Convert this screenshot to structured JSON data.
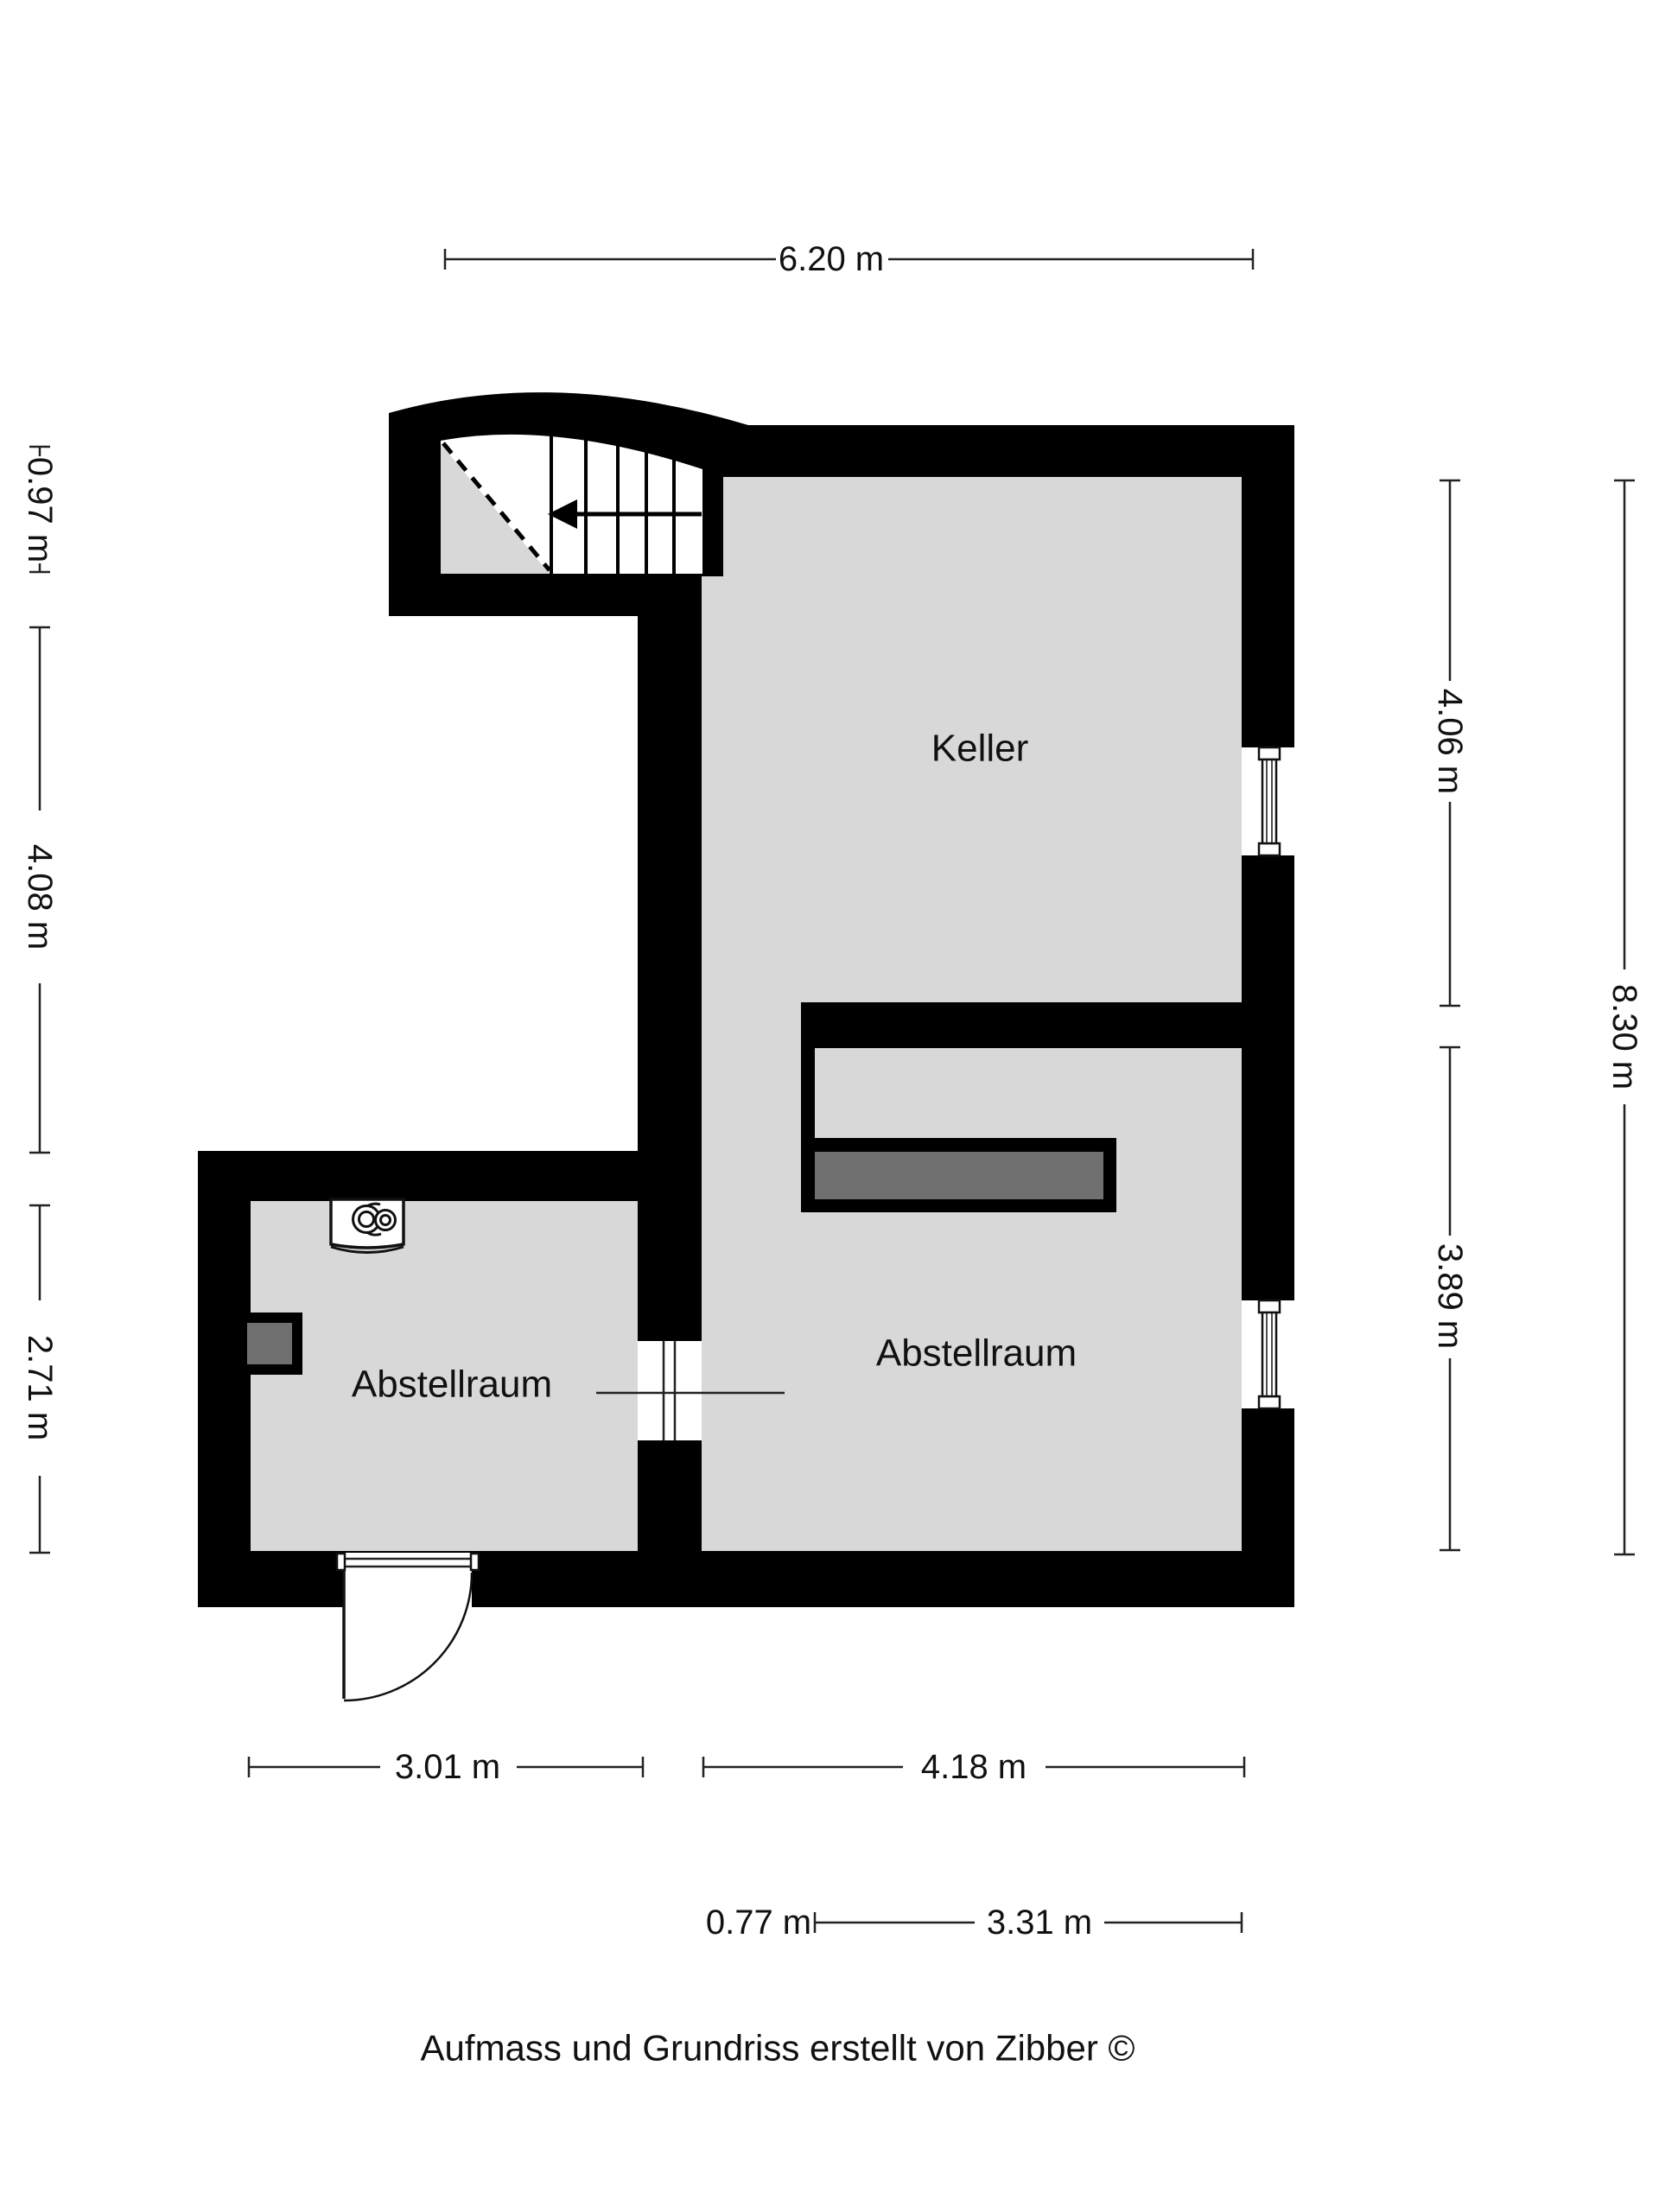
{
  "rooms": {
    "keller": "Keller",
    "abstellraum_left": "Abstellraum",
    "abstellraum_right": "Abstellraum"
  },
  "dimensions": {
    "top_total": "6.20 m",
    "left_stair": "0.97 m",
    "left_keller": "4.08 m",
    "left_room": "2.71 m",
    "right_keller": "4.06 m",
    "right_room": "3.89 m",
    "right_total": "8.30 m",
    "bottom_left_room": "3.01 m",
    "bottom_right_room": "4.18 m",
    "bottom_passage": "0.77 m",
    "bottom_inner": "3.31 m"
  },
  "footer": {
    "credit": "Aufmass und Grundriss erstellt von Zibber ©"
  },
  "colors": {
    "wall": "#000000",
    "floor": "#d8d8d8",
    "shelf": "#6f6f6f",
    "background": "#ffffff"
  }
}
